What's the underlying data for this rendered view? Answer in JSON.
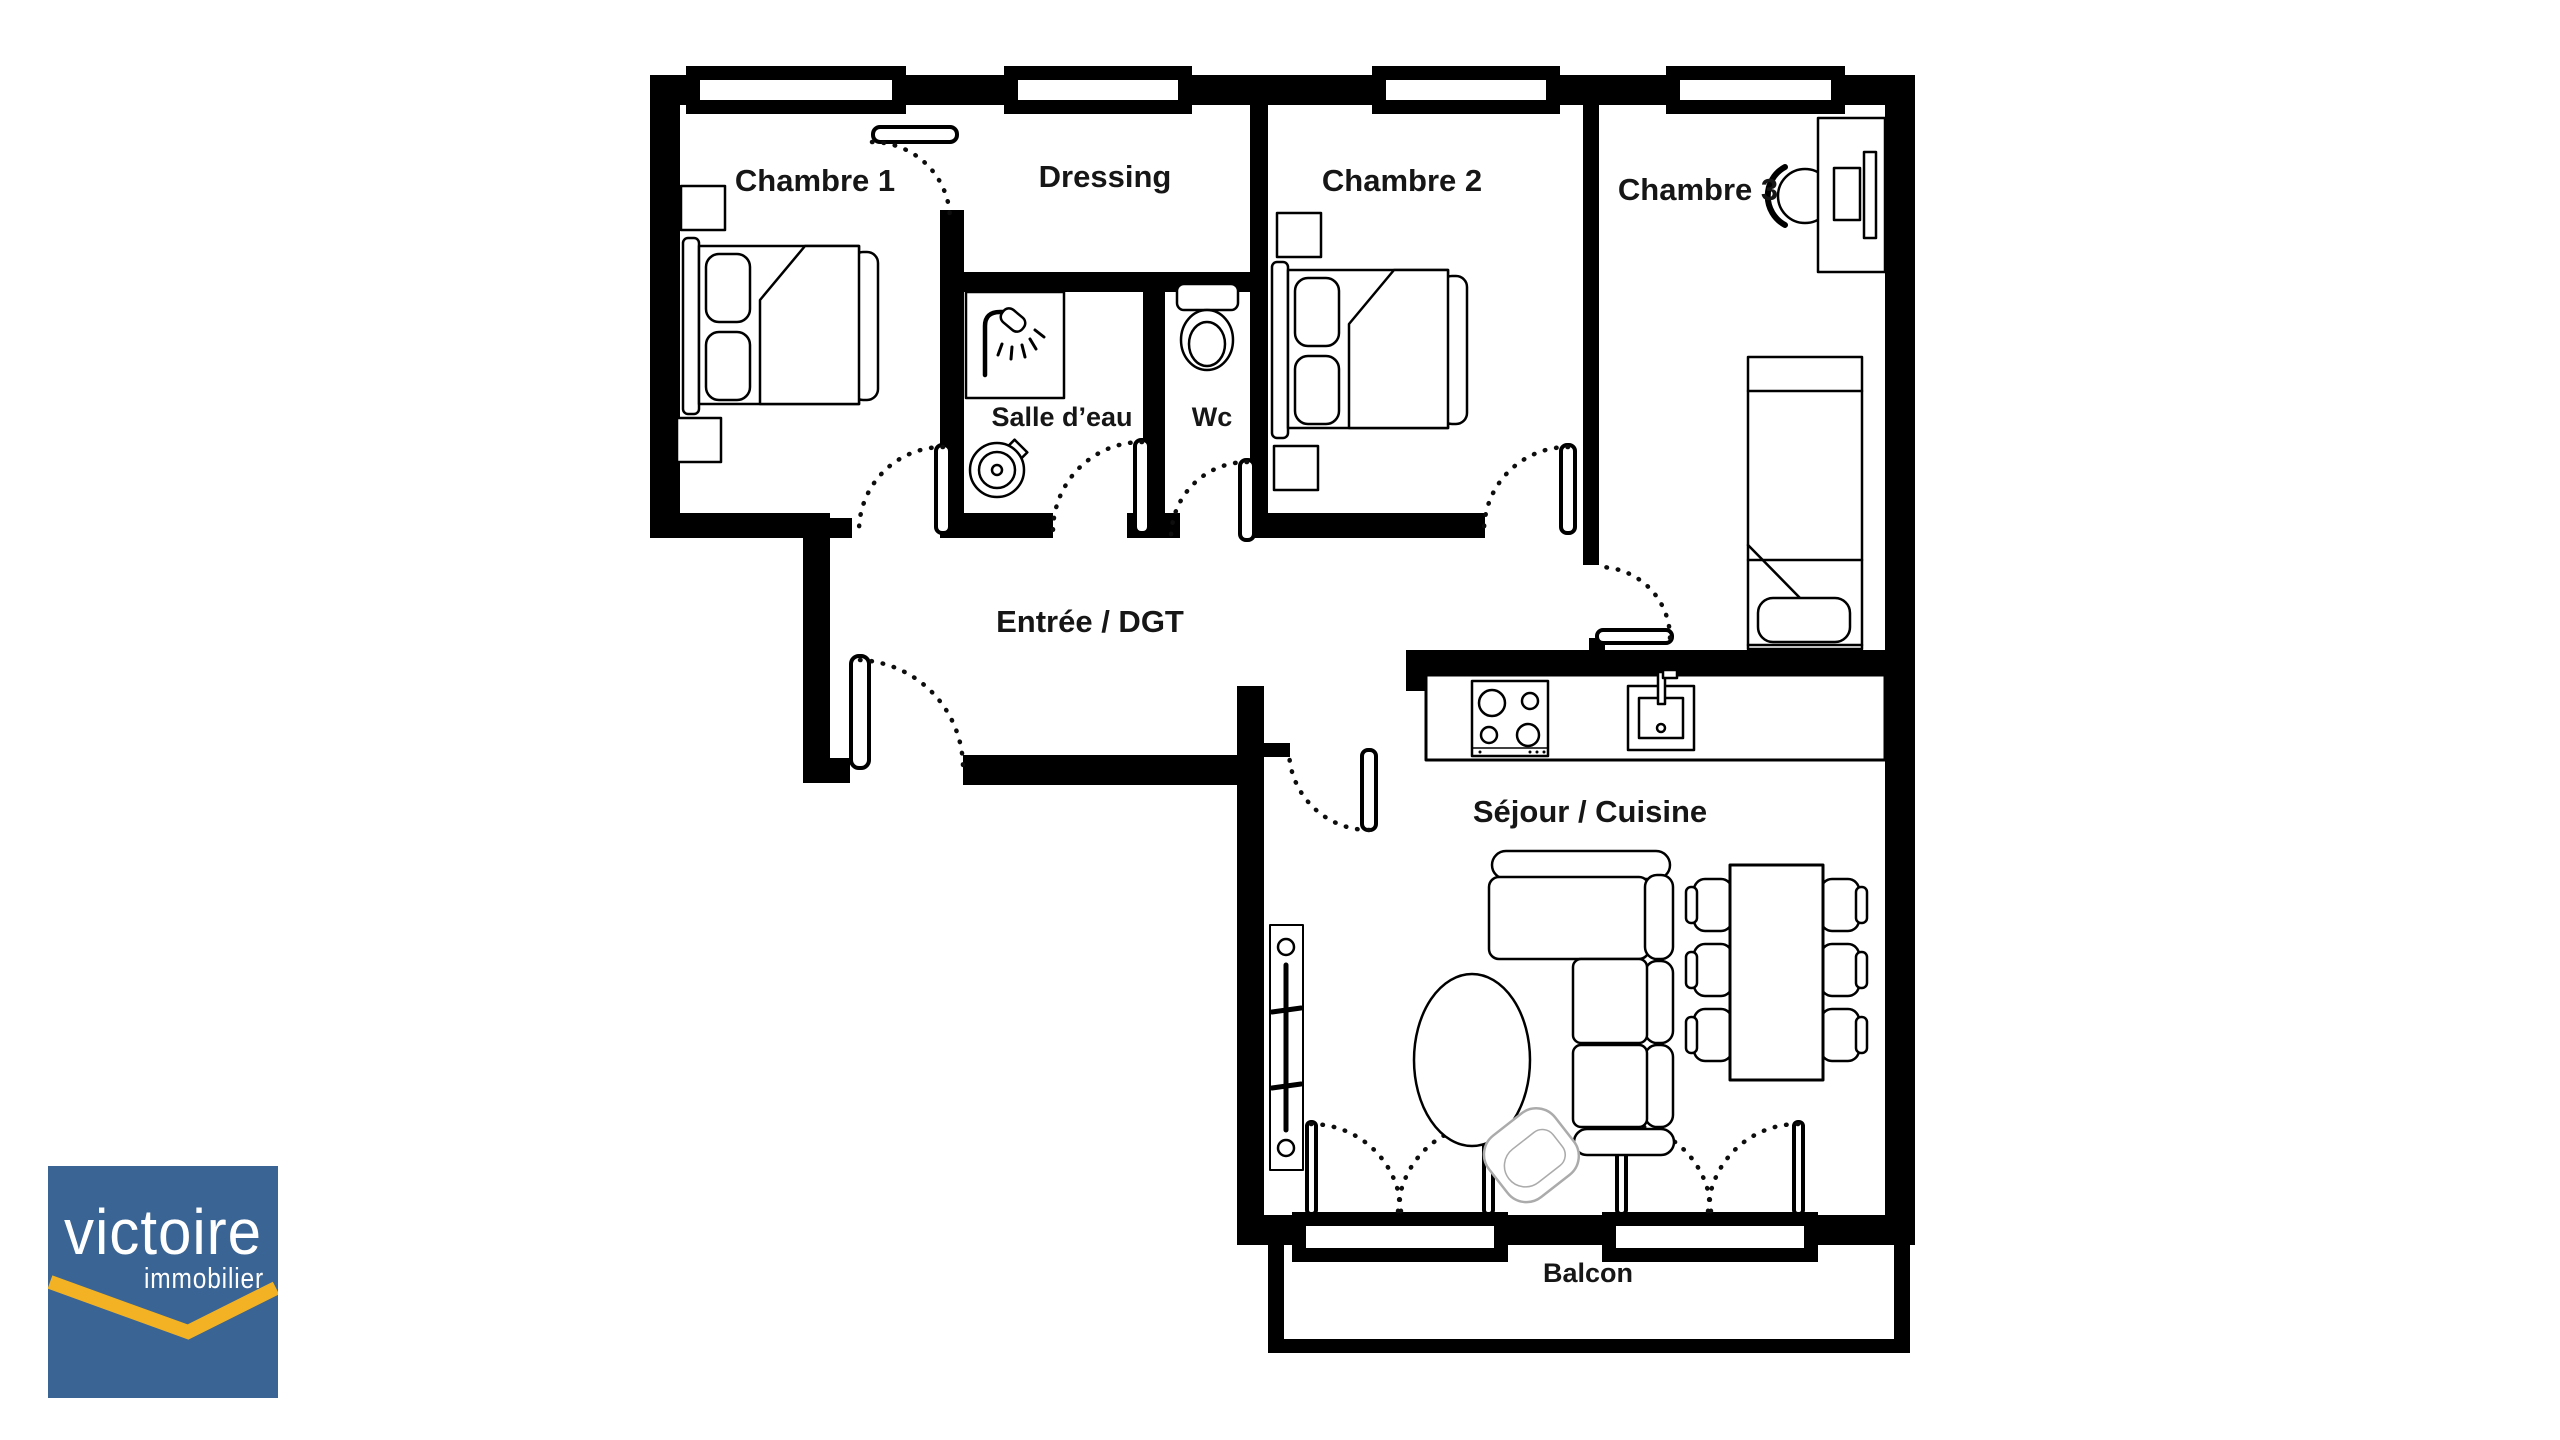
{
  "plan": {
    "wall_color": "#000000",
    "floor_color": "#ffffff",
    "rooms": [
      {
        "id": "chambre1",
        "label": "Chambre 1"
      },
      {
        "id": "dressing",
        "label": "Dressing"
      },
      {
        "id": "chambre2",
        "label": "Chambre 2"
      },
      {
        "id": "chambre3",
        "label": "Chambre 3"
      },
      {
        "id": "salle_deau",
        "label": "Salle d’eau"
      },
      {
        "id": "wc",
        "label": "Wc"
      },
      {
        "id": "entree",
        "label": "Entrée / DGT"
      },
      {
        "id": "sejour",
        "label": "Séjour / Cuisine"
      },
      {
        "id": "balcon",
        "label": "Balcon"
      }
    ],
    "furniture_icons": [
      "double-bed",
      "nightstand",
      "shower",
      "washing-machine",
      "toilet",
      "desk",
      "desk-chair",
      "monitor",
      "single-bed",
      "stove",
      "kitchen-sink",
      "corner-sofa",
      "coffee-table",
      "dining-table",
      "chair",
      "radiator",
      "armchair"
    ]
  },
  "logo": {
    "brand": "victoire",
    "tagline": "immobilier",
    "background_color": "#3a6493",
    "text_color": "#ffffff",
    "chevron_color": "#f2b224"
  }
}
